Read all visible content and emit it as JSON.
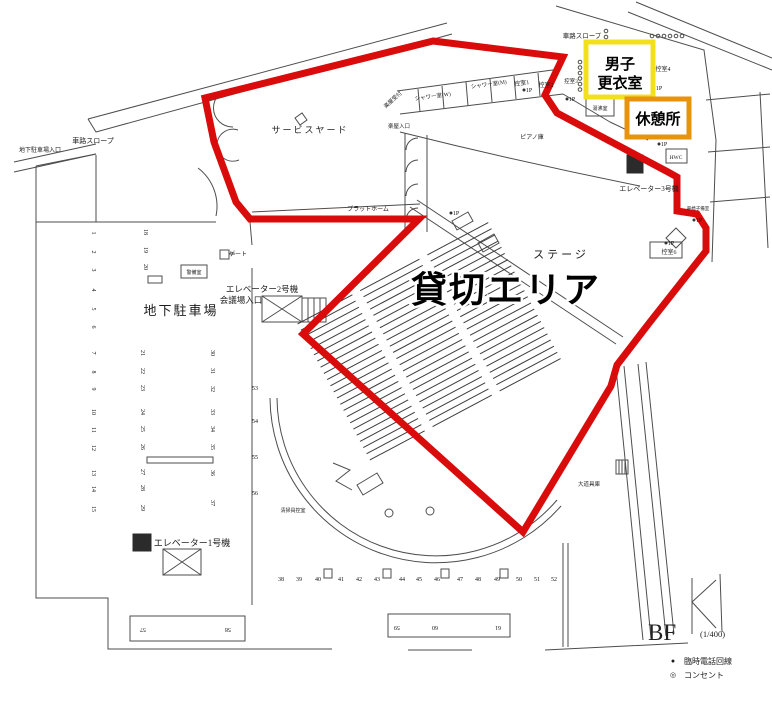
{
  "meta": {
    "floor_label": "BF",
    "scale_label": "(1/400)"
  },
  "legend": {
    "items": [
      {
        "symbol": "●",
        "label": "臨時電話回線"
      },
      {
        "symbol": "◎",
        "label": "コンセント"
      }
    ]
  },
  "highlights": {
    "rental_area": {
      "label": "貸切エリア",
      "color": "#d90b0b"
    },
    "mens_changing_room": {
      "line1": "男子",
      "line2": "更衣室",
      "color": "#f3e01c"
    },
    "rest_area": {
      "label": "休憩所",
      "color": "#e8920e"
    }
  },
  "rooms": {
    "ramp_top": "車路スロープ",
    "ramp_left": "車路スロープ",
    "garage_entrance": "地下駐車場入口",
    "service_yard": "サービスヤード",
    "platform": "プラットホーム",
    "dressing_reception": "楽屋受付",
    "dressing_entrance": "楽屋入口",
    "shower_w": "シャワー室(W)",
    "shower_m": "シャワー室(M)",
    "waiting1": "控室1",
    "waiting2": "控室2",
    "waiting3": "控室3",
    "waiting4": "控室4",
    "kettle": "湯沸室",
    "hwc": "HWC",
    "elevator3": "エレベーター3号機",
    "waiting6": "控室6",
    "wheelchair": "車椅子備室",
    "stage": "ステージ",
    "piano": "ピアノ庫",
    "elevator2": "エレベーター2号機",
    "hall_entrance": "会議場入口",
    "parking_area": "地下駐車場",
    "gate": "ゲート",
    "security": "警備室",
    "elevator1": "エレベーター1号機",
    "cleaning": "清掃員控室",
    "props": "大道具庫",
    "power_marker": "1P"
  },
  "parking": {
    "left_column": [
      "1",
      "2",
      "3",
      "4",
      "5",
      "6",
      "7",
      "8",
      "9",
      "10",
      "11",
      "12",
      "13",
      "14",
      "15"
    ],
    "mid_top_column": [
      "18",
      "19",
      "20"
    ],
    "mid_column": [
      "21",
      "22",
      "23",
      "24",
      "25",
      "26",
      "27",
      "28",
      "29"
    ],
    "right_column": [
      "30",
      "31",
      "32",
      "33",
      "34",
      "35",
      "36",
      "37"
    ],
    "far_right_column": [
      "53",
      "54",
      "55",
      "56"
    ],
    "bottom_row": [
      "38",
      "39",
      "40",
      "41",
      "42",
      "43",
      "44",
      "45",
      "46",
      "47",
      "48",
      "49",
      "50",
      "51",
      "52"
    ],
    "bottom_left_block": [
      "57",
      "58"
    ],
    "bottom_mid_block": [
      "59",
      "60",
      "61"
    ]
  }
}
